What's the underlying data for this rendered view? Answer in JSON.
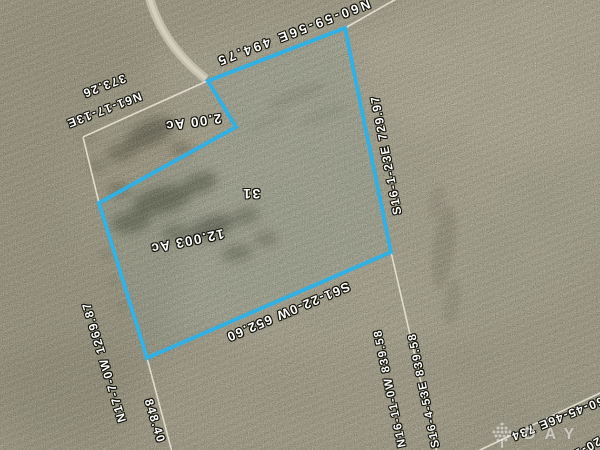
{
  "map": {
    "type": "aerial-parcel-plat-map",
    "colors": {
      "parcel_outline": "#2eb2e8",
      "survey_line": "#ece9db",
      "label_text": "#ffffff",
      "label_outline": "#14140c",
      "ground_base": "#a49d86",
      "ground_light": "#c4bda6",
      "ground_dark": "#5c5a45",
      "road": "#c7c1ae"
    },
    "labels": [
      {
        "id": "bearing-top",
        "text": "N60-59-56E 494.75"
      },
      {
        "id": "distance-nw",
        "text": "373.26"
      },
      {
        "id": "bearing-nw",
        "text": "N61-17-13E"
      },
      {
        "id": "area-small-parcel",
        "text": "2.00 Ac"
      },
      {
        "id": "lot-number",
        "text": "31"
      },
      {
        "id": "area-main-parcel",
        "text": "12.003 Ac"
      },
      {
        "id": "bearing-bottom",
        "text": "S61-22-0W 652.60"
      },
      {
        "id": "bearing-east",
        "text": "S16-1-23E 729.97"
      },
      {
        "id": "bearing-west",
        "text": "N17-7-0W 1269.87"
      },
      {
        "id": "distance-sw",
        "text": "848.40"
      },
      {
        "id": "bearing-se-west",
        "text": "N16-11-0W 839.58"
      },
      {
        "id": "bearing-se-east",
        "text": "S16-4-53E 839.58"
      },
      {
        "id": "bearing-corner-ne",
        "text": "N60-45-46E 734"
      },
      {
        "id": "bearing-corner-n0",
        "text": "N0-20-1W"
      }
    ],
    "watermark": {
      "icon": "tree-logo-icon",
      "text": "DAY"
    }
  }
}
